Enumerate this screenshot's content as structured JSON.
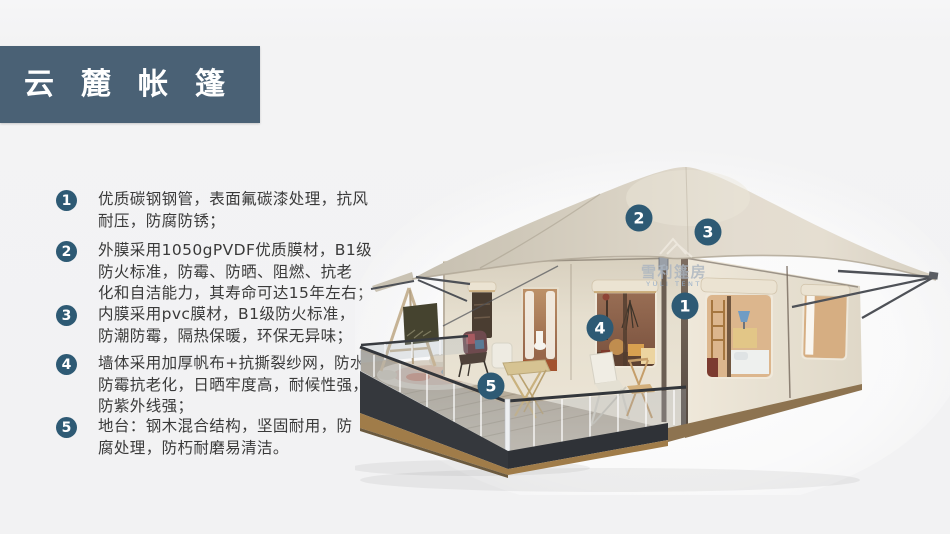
{
  "header": {
    "title": "云麓帐篷"
  },
  "features": [
    {
      "num": "1",
      "text": "优质碳钢钢管，表面氟碳漆处理，抗风\n耐压，防腐防锈；"
    },
    {
      "num": "2",
      "text": "外膜采用1050gPVDF优质膜材，B1级\n防火标准，防霉、防晒、阻燃、抗老\n化和自洁能力，其寿命可达15年左右；"
    },
    {
      "num": "3",
      "text": "内膜采用pvc膜材，B1级防火标准，\n防潮防霉，隔热保暖，环保无异味；"
    },
    {
      "num": "4",
      "text": "墙体采用加厚帆布+抗撕裂纱网，防水\n防霉抗老化，日晒牢度高，耐候性强，\n防紫外线强；"
    },
    {
      "num": "5",
      "text": "地台：钢木混合结构，坚固耐用，防\n腐处理，防朽耐磨易清洁。"
    }
  ],
  "illustration": {
    "watermark_cn": "雪利篷房",
    "watermark_en": "YULI TENT",
    "badges": [
      {
        "num": "1"
      },
      {
        "num": "2"
      },
      {
        "num": "3"
      },
      {
        "num": "4"
      },
      {
        "num": "5"
      }
    ],
    "colors": {
      "badge": "#2e5a74",
      "title_band": "#4a6175",
      "canopy": "#dad3c5",
      "wall": "#eae3d4",
      "deck": "#beb5a5",
      "shade_roll": "#c9a873"
    }
  }
}
